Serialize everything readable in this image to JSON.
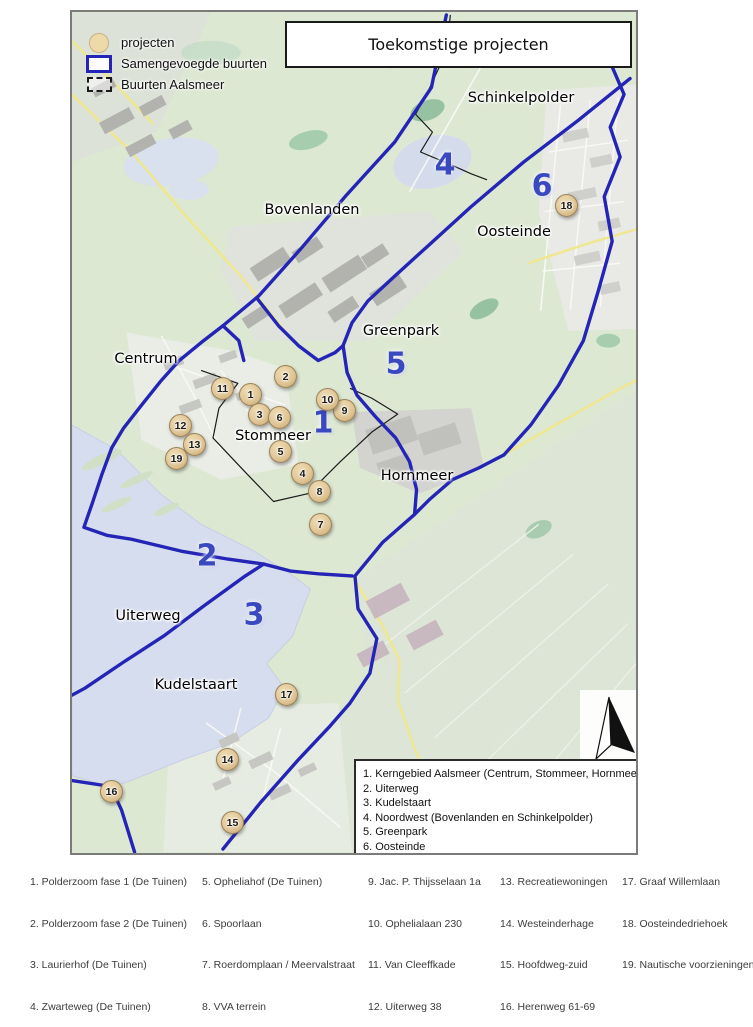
{
  "title": "Toekomstige projecten",
  "legend": {
    "items": [
      {
        "icon": "project-circle",
        "label": "projecten"
      },
      {
        "icon": "blue-rect",
        "label": "Samengevoegde buurten"
      },
      {
        "icon": "dashed-rect",
        "label": "Buurten Aalsmeer"
      }
    ]
  },
  "zones_legend": {
    "items": [
      {
        "n": "1.",
        "label": "Kerngebied Aalsmeer (Centrum, Stommeer, Hornmeer)"
      },
      {
        "n": "2.",
        "label": "Uiterweg"
      },
      {
        "n": "3.",
        "label": "Kudelstaart"
      },
      {
        "n": "4.",
        "label": "Noordwest (Bovenlanden en Schinkelpolder)"
      },
      {
        "n": "5.",
        "label": "Greenpark"
      },
      {
        "n": "6.",
        "label": "Oosteinde"
      }
    ]
  },
  "map": {
    "area_labels": [
      {
        "text": "Schinkelpolder",
        "x": 449,
        "y": 86
      },
      {
        "text": "Bovenlanden",
        "x": 240,
        "y": 198
      },
      {
        "text": "Oosteinde",
        "x": 442,
        "y": 220
      },
      {
        "text": "Greenpark",
        "x": 329,
        "y": 319
      },
      {
        "text": "Centrum",
        "x": 74,
        "y": 347
      },
      {
        "text": "Stommeer",
        "x": 201,
        "y": 424
      },
      {
        "text": "Hornmeer",
        "x": 345,
        "y": 464
      },
      {
        "text": "Uiterweg",
        "x": 76,
        "y": 604
      },
      {
        "text": "Kudelstaart",
        "x": 124,
        "y": 673
      }
    ],
    "zone_numbers": [
      {
        "n": "4",
        "x": 373,
        "y": 153
      },
      {
        "n": "6",
        "x": 470,
        "y": 174
      },
      {
        "n": "5",
        "x": 324,
        "y": 352
      },
      {
        "n": "1",
        "x": 251,
        "y": 411
      },
      {
        "n": "2",
        "x": 135,
        "y": 544
      },
      {
        "n": "3",
        "x": 182,
        "y": 603
      },
      {
        "n": "4b",
        "x": -100,
        "y": -100
      }
    ],
    "markers": [
      {
        "n": "1",
        "x": 178,
        "y": 382
      },
      {
        "n": "2",
        "x": 213,
        "y": 364
      },
      {
        "n": "3",
        "x": 187,
        "y": 402
      },
      {
        "n": "4",
        "x": 230,
        "y": 461
      },
      {
        "n": "5",
        "x": 208,
        "y": 439
      },
      {
        "n": "6",
        "x": 207,
        "y": 405
      },
      {
        "n": "7",
        "x": 248,
        "y": 512
      },
      {
        "n": "8",
        "x": 247,
        "y": 479
      },
      {
        "n": "9",
        "x": 272,
        "y": 398
      },
      {
        "n": "10",
        "x": 255,
        "y": 387
      },
      {
        "n": "11",
        "x": 150,
        "y": 376
      },
      {
        "n": "12",
        "x": 108,
        "y": 413
      },
      {
        "n": "13",
        "x": 122,
        "y": 432
      },
      {
        "n": "14",
        "x": 155,
        "y": 747
      },
      {
        "n": "15",
        "x": 160,
        "y": 810
      },
      {
        "n": "16",
        "x": 39,
        "y": 779
      },
      {
        "n": "17",
        "x": 214,
        "y": 682
      },
      {
        "n": "18",
        "x": 494,
        "y": 193
      },
      {
        "n": "19",
        "x": 104,
        "y": 446
      }
    ]
  },
  "projects": [
    {
      "n": "1.",
      "label": "Polderzoom fase 1 (De Tuinen)"
    },
    {
      "n": "2.",
      "label": "Polderzoom fase 2 (De Tuinen)"
    },
    {
      "n": "3.",
      "label": "Laurierhof (De Tuinen)"
    },
    {
      "n": "4.",
      "label": "Zwarteweg (De Tuinen)"
    },
    {
      "n": "5.",
      "label": "Opheliahof (De Tuinen)"
    },
    {
      "n": "6.",
      "label": "Spoorlaan"
    },
    {
      "n": "7.",
      "label": "Roerdomplaan / Meervalstraat"
    },
    {
      "n": "8.",
      "label": "VVA terrein"
    },
    {
      "n": "9.",
      "label": "Jac. P. Thijsselaan 1a"
    },
    {
      "n": "10.",
      "label": "Ophelialaan 230"
    },
    {
      "n": "11.",
      "label": "Van Cleeffkade"
    },
    {
      "n": "12.",
      "label": "Uiterweg 38"
    },
    {
      "n": "13.",
      "label": "Recreatiewoningen"
    },
    {
      "n": "14.",
      "label": "Westeinderhage"
    },
    {
      "n": "15.",
      "label": "Hoofdweg-zuid"
    },
    {
      "n": "16.",
      "label": "Herenweg 61-69"
    },
    {
      "n": "17.",
      "label": "Graaf Willemlaan"
    },
    {
      "n": "18.",
      "label": "Oosteindedriehoek"
    },
    {
      "n": "19.",
      "label": "Nautische voorzieningen"
    }
  ],
  "colors": {
    "boundary_blue": "#2424b6",
    "marker_fill": "#e0c697",
    "zone_number_blue": "#3a49c0"
  }
}
